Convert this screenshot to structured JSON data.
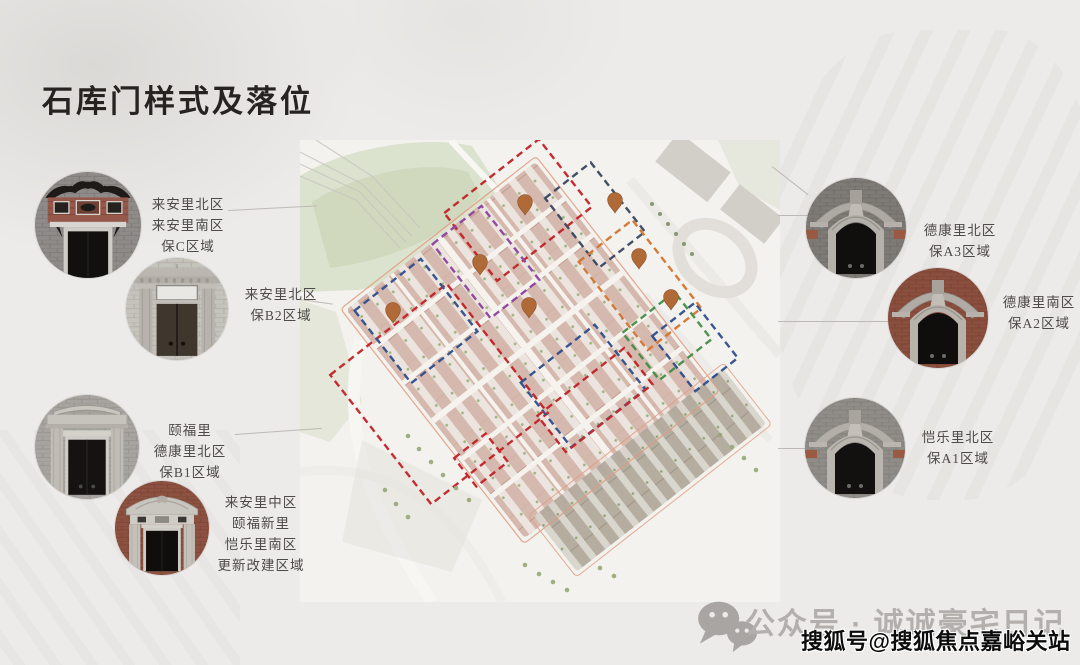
{
  "title": "石库门样式及落位",
  "map": {
    "type": "site-plan",
    "pin_count": 7,
    "pin_color": "#b06a38",
    "boundary_colors": {
      "red": "#c01f24",
      "blue": "#2b4b8a",
      "navy": "#35445c",
      "purple": "#8a3f9e",
      "orange": "#d2722e",
      "green": "#3f8c43",
      "site_outline": "#e09a7e"
    }
  },
  "gates": [
    {
      "photo": "ornate-brick-pediment-gate",
      "lines": [
        "来安里北区",
        "来安里南区",
        "保C区域"
      ]
    },
    {
      "photo": "stone-lintel-gate",
      "lines": [
        "来安里北区",
        "保B2区域"
      ]
    },
    {
      "photo": "flat-arch-stone-gate",
      "lines": [
        "颐福里",
        "德康里北区",
        "保B1区域"
      ]
    },
    {
      "photo": "baroque-redbrick-gate",
      "lines": [
        "来安里中区",
        "颐福新里",
        "恺乐里南区",
        "更新改建区域"
      ]
    },
    {
      "photo": "arched-graybrick-gate",
      "lines": [
        "德康里北区",
        "保A3区域"
      ]
    },
    {
      "photo": "arched-redbrick-gate",
      "lines": [
        "德康里南区",
        "保A2区域"
      ]
    },
    {
      "photo": "arched-graybrick-gate",
      "lines": [
        "恺乐里北区",
        "保A1区域"
      ]
    }
  ],
  "footer": {
    "wechat_label": "公众号 · 诚诚豪宅日记",
    "watermark": "搜狐号@搜狐焦点嘉峪关站"
  }
}
